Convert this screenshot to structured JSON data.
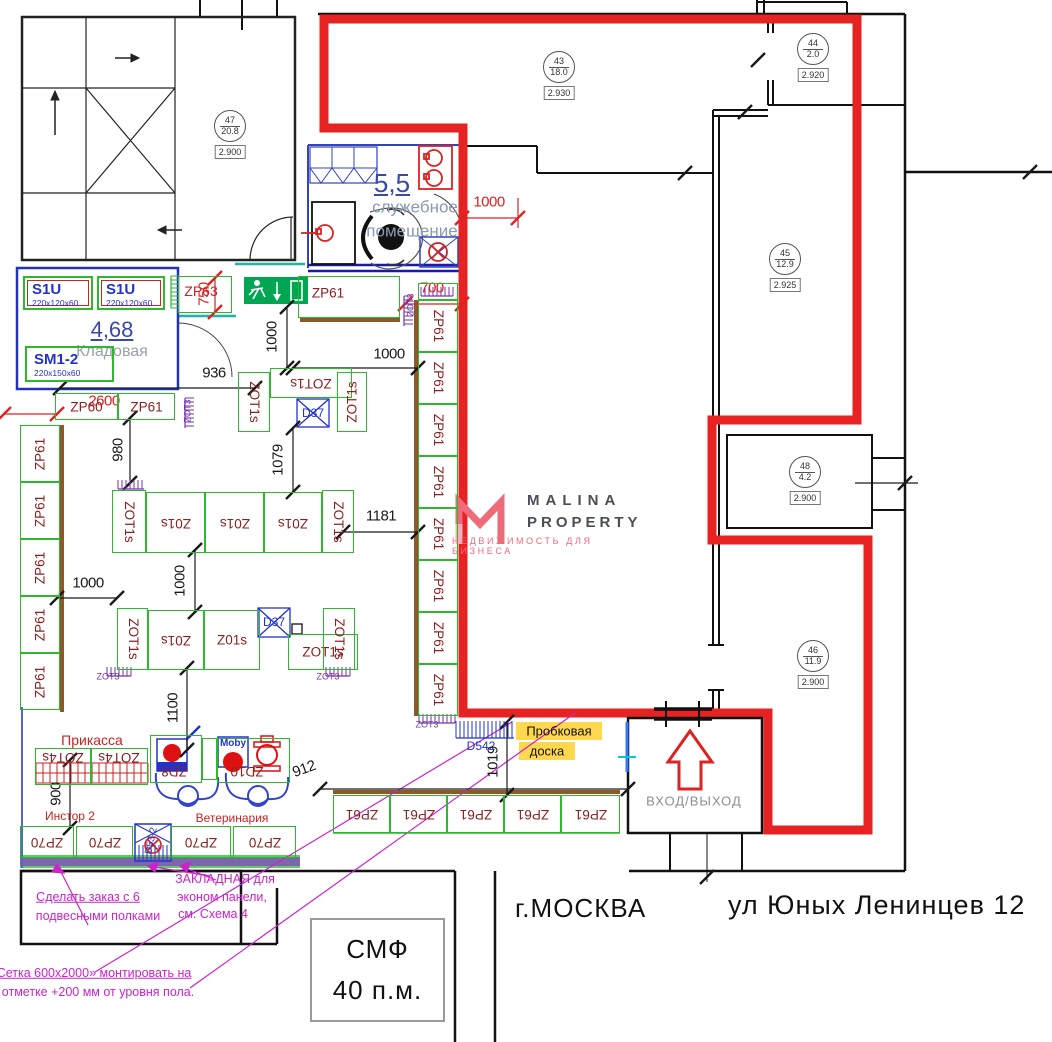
{
  "branding": {
    "line1": "MALINA",
    "line2": "PROPERTY",
    "tagline": "НЕДВИЖИМОСТЬ ДЛЯ БИЗНЕСА"
  },
  "address": {
    "city": "г.МОСКВА",
    "street": "ул Юных Ленинцев 12"
  },
  "stamp": {
    "line1": "СМФ",
    "line2": "40 п.м."
  },
  "colors": {
    "green": "#2db82d",
    "red_outline": "#e62222",
    "dim_red": "#dd2222",
    "maroon": "#8b2020",
    "blue": "#2233cc",
    "purple": "#7733aa",
    "magenta": "#cc22cc",
    "brown": "#8a5a2b",
    "strip_purple": "#7b68aa",
    "yellow": "#ffd84d",
    "teal": "#20b2aa",
    "exit_green": "#00a651"
  },
  "rooms": [
    {
      "num": "47",
      "area": "20.8",
      "elev": "2.900",
      "x": 229,
      "y": 125
    },
    {
      "num": "43",
      "area": "18.0",
      "elev": "2.930",
      "x": 558,
      "y": 66
    },
    {
      "num": "44",
      "area": "2.0",
      "elev": "2.920",
      "x": 812,
      "y": 48
    },
    {
      "num": "45",
      "area": "12.9",
      "elev": "2.925",
      "x": 784,
      "y": 258
    },
    {
      "num": "48",
      "area": "4.2",
      "elev": "2.900",
      "x": 804,
      "y": 471
    },
    {
      "num": "46",
      "area": "11.9",
      "elev": "2.900",
      "x": 812,
      "y": 655
    }
  ],
  "plan": {
    "labels": [
      [
        "5,5",
        392,
        183,
        0,
        "b26 u"
      ],
      [
        "служебное",
        415,
        207,
        0,
        "gb17"
      ],
      [
        "помещение",
        412,
        231,
        0,
        "gb17"
      ],
      [
        "4,68",
        112,
        330,
        0,
        "b22 u"
      ],
      [
        "Кладовая",
        112,
        352,
        0,
        "gy16"
      ],
      [
        "Прикасса",
        92,
        740,
        0,
        "rd14"
      ],
      [
        "Инстор 2",
        70,
        816,
        0,
        "rd12"
      ],
      [
        "Ветеринария",
        232,
        818,
        0,
        "rd12"
      ],
      [
        "Пробковая",
        559,
        731,
        0,
        "bk13"
      ],
      [
        "доска",
        547,
        751,
        0,
        "bk13"
      ],
      [
        "D542",
        481,
        746,
        0,
        "bl12"
      ],
      [
        "D37",
        313,
        413,
        0,
        "bl12"
      ],
      [
        "D37",
        274,
        622,
        0,
        "bl12"
      ],
      [
        "D53-2",
        152,
        841,
        -78,
        "bl11"
      ],
      [
        "Moby",
        233,
        744,
        0,
        "bl10"
      ],
      [
        "ZP63",
        201,
        291,
        0,
        "rd14"
      ],
      [
        "ZOT3",
        188,
        411,
        -90,
        "pu"
      ],
      [
        "ZOT3",
        411,
        305,
        -90,
        "pu"
      ],
      [
        "ZOT3",
        108,
        677,
        0,
        "pu"
      ],
      [
        "ZOT3",
        328,
        677,
        0,
        "pu"
      ],
      [
        "ZOT3",
        427,
        725,
        0,
        "pu"
      ],
      [
        "ВХОД/ВЫХОД",
        694,
        801,
        0,
        "gy13"
      ],
      [
        "Сделать заказ с 6",
        88,
        897,
        0,
        "mg13 u"
      ],
      [
        "подвесными полками",
        98,
        916,
        0,
        "mg13"
      ],
      [
        "ЗАКЛАДНАЯ для",
        225,
        879,
        0,
        "mg13"
      ],
      [
        "эконом панели,",
        222,
        897,
        0,
        "mg13"
      ],
      [
        "см. Схема 4",
        213,
        914,
        0,
        "mg13"
      ],
      [
        "Сетка 600x2000» монтировать на",
        94,
        973,
        0,
        "mg13 u"
      ],
      [
        "отметке +200 мм от уровня пола.",
        98,
        992,
        0,
        "mg13"
      ]
    ],
    "dims": [
      [
        60,
        388,
        255,
        388,
        "936",
        214,
        373,
        0
      ],
      [
        287,
        307,
        287,
        368,
        "1000",
        272,
        337,
        -90
      ],
      [
        293,
        368,
        418,
        368,
        "1000",
        389,
        354,
        0
      ],
      [
        293,
        428,
        293,
        492,
        "1079",
        278,
        460,
        -90
      ],
      [
        343,
        532,
        418,
        532,
        "1181",
        381,
        516,
        0
      ],
      [
        195,
        550,
        195,
        612,
        "1000",
        180,
        581,
        -90
      ],
      [
        57,
        598,
        117,
        598,
        "1000",
        88,
        583,
        0
      ],
      [
        130,
        418,
        130,
        483,
        "980",
        118,
        450,
        -90
      ],
      [
        187,
        668,
        187,
        750,
        "1100",
        173,
        708,
        -90
      ],
      [
        70,
        760,
        70,
        828,
        "900",
        56,
        794,
        -90
      ],
      [
        320,
        789,
        628,
        789,
        "912",
        304,
        769,
        -20
      ],
      [
        507,
        722,
        507,
        795,
        "1019",
        493,
        762,
        -90
      ]
    ],
    "red_dims": [
      [
        462,
        218,
        518,
        218,
        "1000",
        489,
        202,
        0
      ],
      [
        405,
        304,
        462,
        304,
        "700",
        432,
        288,
        0
      ],
      [
        215,
        278,
        215,
        312,
        "750",
        204,
        294,
        -90
      ],
      [
        4,
        414,
        57,
        414,
        "2600",
        104,
        401,
        0
      ]
    ],
    "ticks": [
      [
        685,
        173
      ],
      [
        758,
        60
      ],
      [
        745,
        112
      ],
      [
        905,
        483
      ],
      [
        1030,
        172
      ],
      [
        707,
        877
      ]
    ],
    "plain_lines": [
      [
        855,
        483,
        918,
        483
      ]
    ],
    "shelves": [
      [
        20,
        425,
        40,
        57,
        "ZP61",
        -90
      ],
      [
        20,
        482,
        40,
        57,
        "ZP61",
        -90
      ],
      [
        20,
        539,
        40,
        57,
        "ZP61",
        -90
      ],
      [
        20,
        596,
        40,
        57,
        "ZP61",
        -90
      ],
      [
        20,
        653,
        40,
        57,
        "ZP61",
        -90
      ],
      [
        55,
        393,
        63,
        27,
        "ZP60",
        0
      ],
      [
        118,
        393,
        57,
        27,
        "ZP61",
        0
      ],
      [
        298,
        276,
        102,
        42,
        "ZP61",
        0,
        328,
        293
      ],
      [
        178,
        276,
        54,
        37,
        "",
        0
      ],
      [
        418,
        283,
        40,
        17,
        "",
        0
      ],
      [
        418,
        300,
        40,
        52,
        "ZP61",
        90
      ],
      [
        418,
        352,
        40,
        52,
        "ZP61",
        90
      ],
      [
        418,
        404,
        40,
        52,
        "ZP61",
        90
      ],
      [
        418,
        456,
        40,
        52,
        "ZP61",
        90
      ],
      [
        418,
        508,
        40,
        52,
        "ZP61",
        90
      ],
      [
        418,
        560,
        40,
        52,
        "ZP61",
        90
      ],
      [
        418,
        612,
        40,
        52,
        "ZP61",
        90
      ],
      [
        418,
        664,
        40,
        52,
        "ZP61",
        90
      ],
      [
        238,
        372,
        32,
        60,
        "ZOT1s",
        90
      ],
      [
        270,
        368,
        82,
        30,
        "ZOT1s",
        180
      ],
      [
        337,
        372,
        30,
        60,
        "ZOT1s",
        -90
      ],
      [
        112,
        490,
        34,
        63,
        "ZOT1s",
        90
      ],
      [
        146,
        492,
        59,
        61,
        "Z01s",
        180
      ],
      [
        205,
        492,
        59,
        61,
        "Z01s",
        180
      ],
      [
        264,
        492,
        58,
        61,
        "Z01s",
        180
      ],
      [
        322,
        490,
        32,
        63,
        "ZOT1s",
        90
      ],
      [
        117,
        608,
        31,
        62,
        "ZOT1s",
        90
      ],
      [
        148,
        610,
        56,
        60,
        "Z01s",
        180
      ],
      [
        204,
        610,
        56,
        60,
        "Z01s",
        0
      ],
      [
        288,
        634,
        70,
        36,
        "ZOT1s",
        0
      ],
      [
        323,
        608,
        32,
        62,
        "ZOT1s",
        90
      ],
      [
        333,
        795,
        57,
        38,
        "ZP61",
        180
      ],
      [
        390,
        795,
        57,
        38,
        "ZP61",
        180
      ],
      [
        447,
        795,
        57,
        38,
        "ZP61",
        180
      ],
      [
        504,
        795,
        57,
        38,
        "ZP61",
        180
      ],
      [
        561,
        795,
        59,
        38,
        "ZP61",
        180
      ],
      [
        20,
        826,
        54,
        32,
        "ZP70",
        180
      ],
      [
        76,
        826,
        57,
        32,
        "ZP70",
        180
      ],
      [
        170,
        826,
        61,
        32,
        "ZP70",
        180
      ],
      [
        233,
        826,
        63,
        32,
        "ZP70",
        180
      ],
      [
        35,
        748,
        56,
        37,
        "ZOT4s",
        180,
        63,
        757
      ],
      [
        91,
        748,
        57,
        37,
        "ZOT4s",
        180,
        119,
        757
      ],
      [
        150,
        735,
        52,
        48,
        "ZD8",
        180,
        174,
        771
      ],
      [
        202,
        738,
        15,
        42,
        "",
        0
      ],
      [
        217,
        738,
        73,
        45,
        "ZD10",
        180,
        247,
        771
      ]
    ],
    "cabinets": [
      [
        23,
        276,
        70,
        34,
        "S1U",
        "220x120x60",
        1
      ],
      [
        97,
        276,
        68,
        34,
        "S1U",
        "220x120x60",
        1
      ],
      [
        25,
        346,
        89,
        36,
        "SM1-2",
        "220x150x60",
        0
      ]
    ],
    "combs": [
      [
        118,
        480,
        26,
        "h",
        "pu",
        9
      ],
      [
        185,
        398,
        30,
        "v",
        "pu",
        9
      ],
      [
        404,
        296,
        30,
        "v",
        "pu",
        9
      ],
      [
        421,
        287,
        32,
        "h",
        "pu",
        9
      ],
      [
        107,
        667,
        24,
        "h",
        "pu",
        9
      ],
      [
        326,
        667,
        24,
        "h",
        "pu",
        9
      ],
      [
        419,
        714,
        36,
        "h",
        "pu",
        9
      ],
      [
        456,
        721,
        58,
        "h",
        "bl",
        17
      ],
      [
        171,
        276,
        32,
        "v",
        "gr",
        8
      ]
    ],
    "grids": [
      [
        36,
        763,
        112,
        20
      ]
    ]
  }
}
